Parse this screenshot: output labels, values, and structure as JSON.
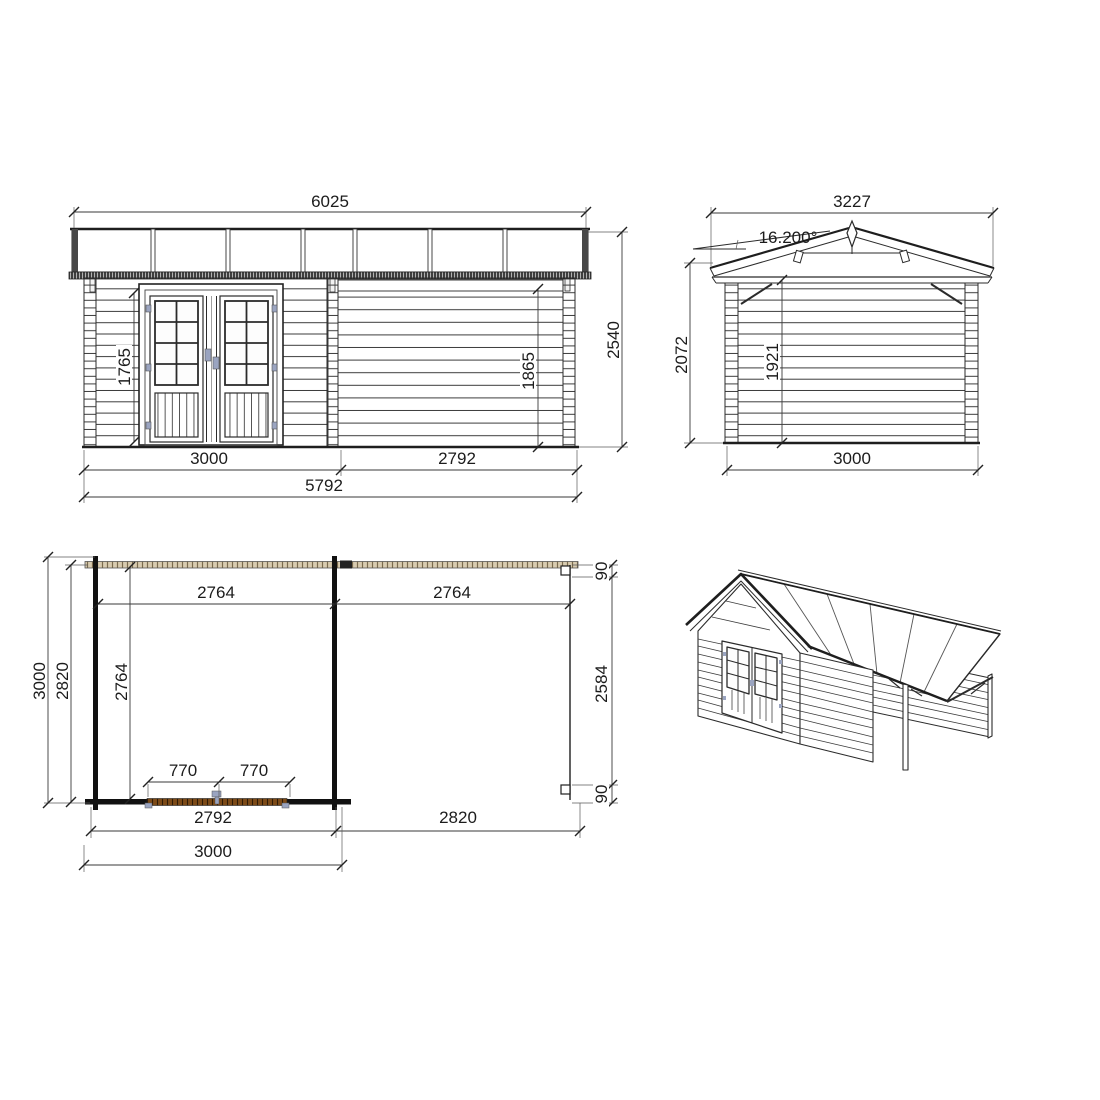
{
  "colors": {
    "line": "#2b2b2b",
    "eave_strip": "#3f3f3f",
    "plan_beam_fill": "#d8cbb0",
    "plan_beam_hatch": "#7a6a4c",
    "plan_door_strip": "#7c4a17",
    "hardware_blue": "#9aa4c0",
    "text": "#1c1c1c"
  },
  "views": {
    "front_elevation": {
      "dims": {
        "roof_width": "6025",
        "overall_height": "2540",
        "door_height": "1765",
        "eave_height": "1865",
        "cabin_width": "3000",
        "annex_width": "2792",
        "total_width": "5792"
      }
    },
    "side_elevation": {
      "dims": {
        "roof_width": "3227",
        "roof_pitch": "16.200°",
        "overall_height": "2072",
        "wall_height": "1921",
        "base_width": "3000"
      }
    },
    "floor_plan": {
      "dims": {
        "depth_overall": "3000",
        "depth_wall": "2820",
        "depth_inner": "2764",
        "cabin_span": "2764",
        "annex_span": "2764",
        "post_top": "90",
        "annex_depth_inner": "2584",
        "post_bottom": "90",
        "door_leaf_left": "770",
        "door_leaf_right": "770",
        "cabin_width_inner": "2792",
        "annex_width": "2820",
        "cabin_width_outer": "3000"
      }
    }
  }
}
